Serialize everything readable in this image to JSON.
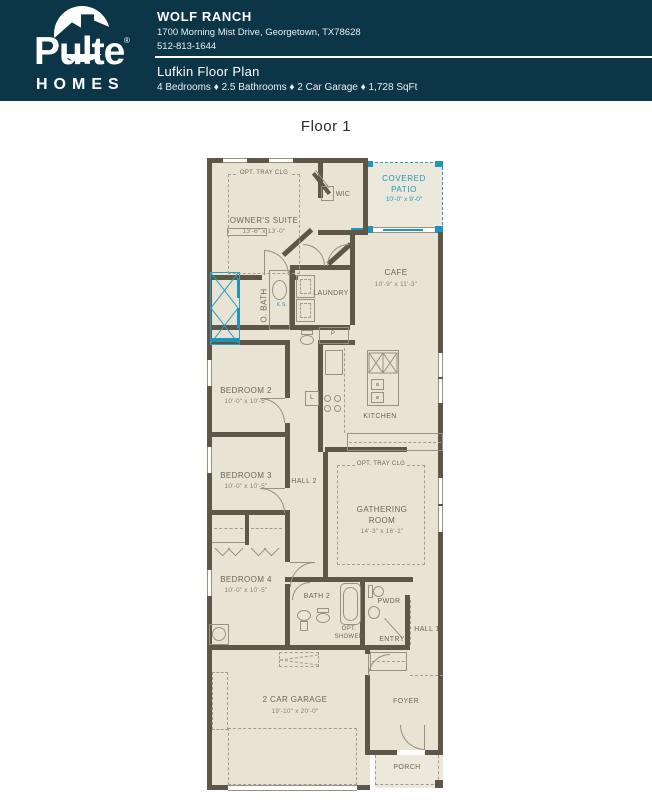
{
  "colors": {
    "header_bg": "#0c3547",
    "accent_teal": "#2095ba",
    "wall": "#5f564a",
    "floor_fill": "#e9e3d4"
  },
  "header": {
    "logo": {
      "brand": "Pulte",
      "reg": "®",
      "sub": "HOMES"
    },
    "community": "WOLF RANCH",
    "address": "1700 Morning Mist Drive, Georgetown, TX78628",
    "phone": "512-813-1644",
    "plan_title": "Lufkin Floor Plan",
    "plan_specs": "4 Bedrooms ♦ 2.5 Bathrooms ♦ 2 Car Garage ♦ 1,728 SqFt"
  },
  "floor_label": "Floor 1",
  "rooms": {
    "owners_suite": {
      "name": "OWNER'S SUITE",
      "dims": "13'-6\" x 13'-0\""
    },
    "covered_patio": {
      "l1": "COVERED",
      "l2": "PATIO",
      "dims": "10'-0\" x 9'-0\""
    },
    "cafe": {
      "name": "CAFE",
      "dims": "10'-9\" x 11'-3\""
    },
    "kitchen": {
      "name": "KITCHEN"
    },
    "bedroom2": {
      "name": "BEDROOM 2",
      "dims": "10'-0\" x 10'-5\""
    },
    "bedroom3": {
      "name": "BEDROOM 3",
      "dims": "10'-0\" x 10'-5\""
    },
    "bedroom4": {
      "name": "BEDROOM 4",
      "dims": "10'-0\" x 10'-5\""
    },
    "gathering": {
      "l1": "GATHERING",
      "l2": "ROOM",
      "dims": "14'-3\" x 16'-1\""
    },
    "garage": {
      "name": "2 CAR GARAGE",
      "dims": "19'-10\" x 20'-0\""
    }
  },
  "labels": {
    "opt_tray": "OPT. TRAY CLG",
    "wic": "WIC",
    "linen": "L",
    "o_bath": "O. BATH",
    "ks": "K.S.",
    "laundry": "LAUNDRY",
    "pantry": "P",
    "hall2": "HALL 2",
    "hall1": "HALL 1",
    "bath2": "BATH 2",
    "pwdr": "PWDR",
    "opt_shower_l1": "OPT.",
    "opt_shower_l2": "SHOWER",
    "entry": "ENTRY",
    "foyer": "FOYER",
    "porch": "PORCH"
  }
}
